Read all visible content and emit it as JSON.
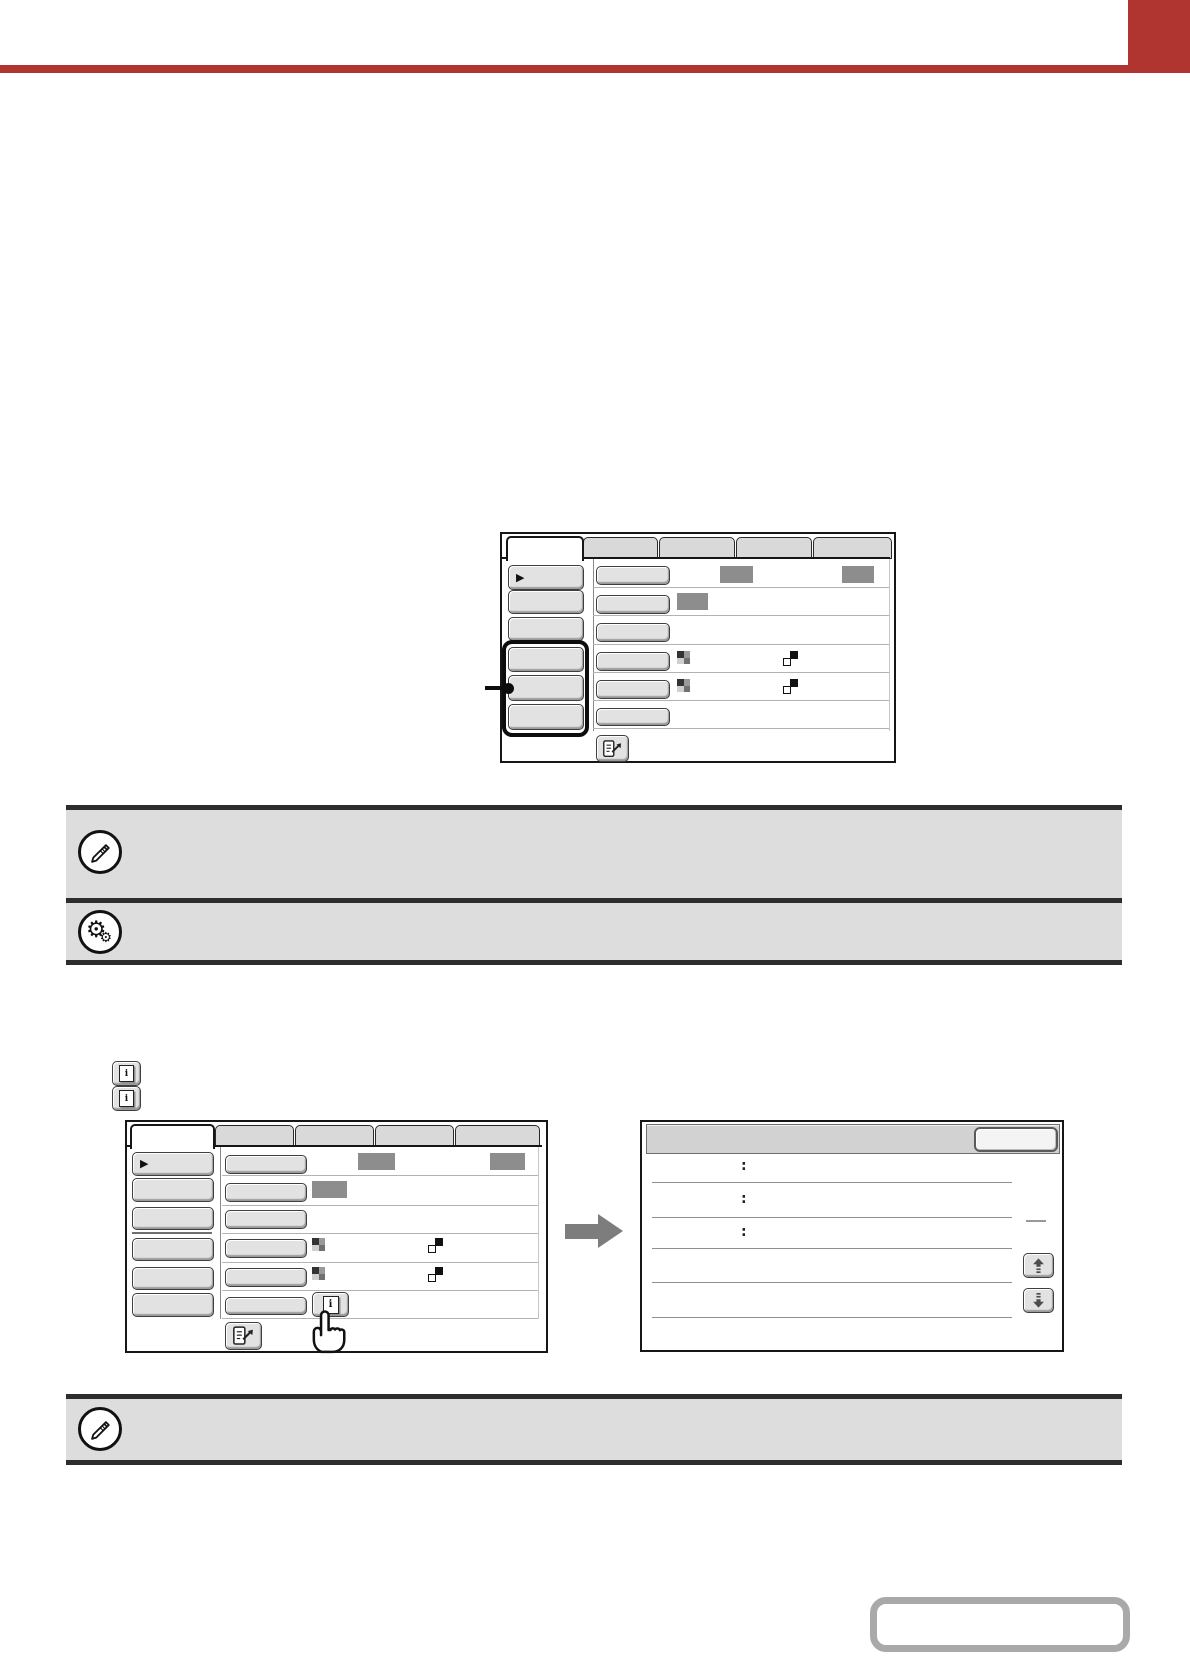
{
  "colors": {
    "accent_red": "#b0342f",
    "note_fill": "#dddddd",
    "note_border": "#2d2d2d",
    "ui_button_fill": "#e2e2e2",
    "value_placeholder_gray": "#8d8d8d",
    "flow_arrow_gray": "#7d7d7d",
    "contents_button_border": "#a9a9a9"
  },
  "labels": {
    "info_icon": "i"
  },
  "icons": {
    "menu_arrow": "▶",
    "gear": "⚙",
    "note_icons": [
      "pencil-icon",
      "gears-icon",
      "pencil-icon"
    ]
  },
  "fig3": {
    "row_labels": [
      ":",
      ":",
      ":"
    ]
  }
}
